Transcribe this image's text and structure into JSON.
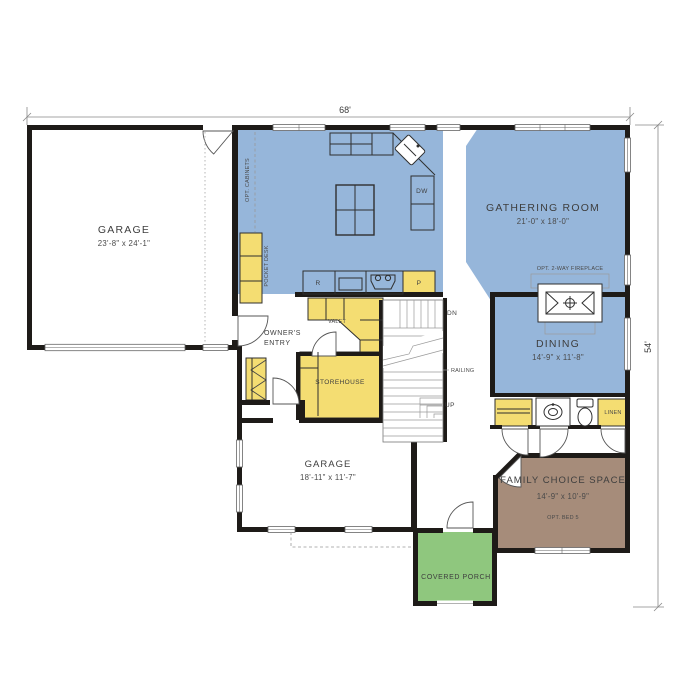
{
  "colors": {
    "room_blue": "#96B6DA",
    "accent_yellow": "#F4DD72",
    "porch_green": "#8FC77E",
    "bed_brown": "#A68C7A",
    "wall_black": "#1E1B18"
  },
  "dimensions": {
    "width": "68'",
    "height": "54'"
  },
  "rooms": {
    "garage_main": {
      "name": "GARAGE",
      "size": "23'-8\" x 24'-1\""
    },
    "gathering": {
      "name": "GATHERING ROOM",
      "size": "21'-0\" x 18'-0\""
    },
    "dining": {
      "name": "DINING",
      "size": "14'-9\" x 11'-8\""
    },
    "garage_rear": {
      "name": "GARAGE",
      "size": "18'-11\" x 11'-7\""
    },
    "family_choice": {
      "name": "FAMILY CHOICE SPACE",
      "size": "14'-9\" x 10'-9\"",
      "option": "OPT. BED 5"
    },
    "covered_porch": {
      "name": "COVERED PORCH"
    },
    "owners_entry": {
      "line1": "OWNER'S",
      "line2": "ENTRY"
    },
    "storehouse": {
      "name": "STOREHOUSE"
    }
  },
  "labels": {
    "valet": "VALET",
    "pocket_desk": "POCKET DESK",
    "opt_cabinets": "OPT. CABINETS",
    "dishwasher": "DW",
    "range": "R",
    "pantry": "P",
    "down": "DN",
    "up": "UP",
    "railing": "RAILING",
    "linen": "LINEN",
    "fireplace": "OPT. 2-WAY FIREPLACE"
  }
}
